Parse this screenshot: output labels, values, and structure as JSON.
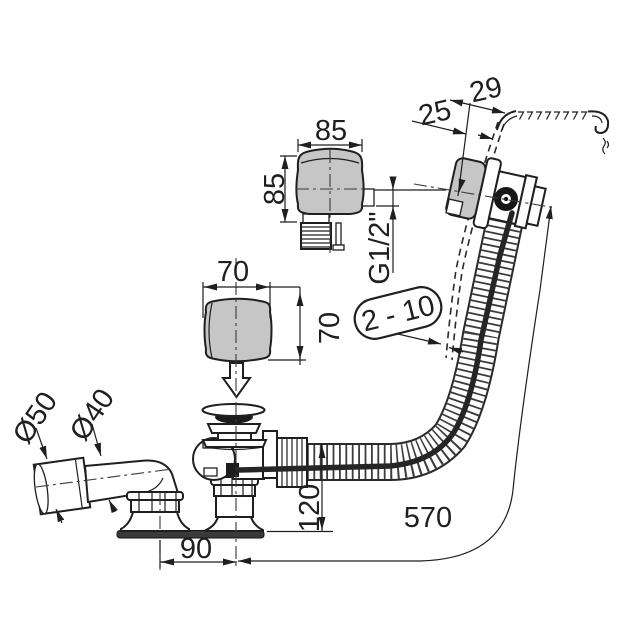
{
  "title": "Bath waste and overflow set — dimensioned technical drawing",
  "labels": {
    "knob_large_width": "85",
    "knob_large_height": "85",
    "thread_size": "G1/2\"",
    "knob_small_width": "70",
    "knob_small_height": "70",
    "rim_width": "29",
    "rim_overhang": "25",
    "wall_thickness_range": "2 - 10",
    "outlet_sleeve_diameter": "Ø50",
    "outlet_pipe_diameter": "Ø40",
    "drain_height": "120",
    "outlet_offset": "90",
    "hose_length": "570"
  },
  "colors": {
    "line": "#1f1f1f",
    "gray_fill": "#c6c6c6",
    "dark_fill": "#2a2a2a",
    "background": "#ffffff"
  }
}
